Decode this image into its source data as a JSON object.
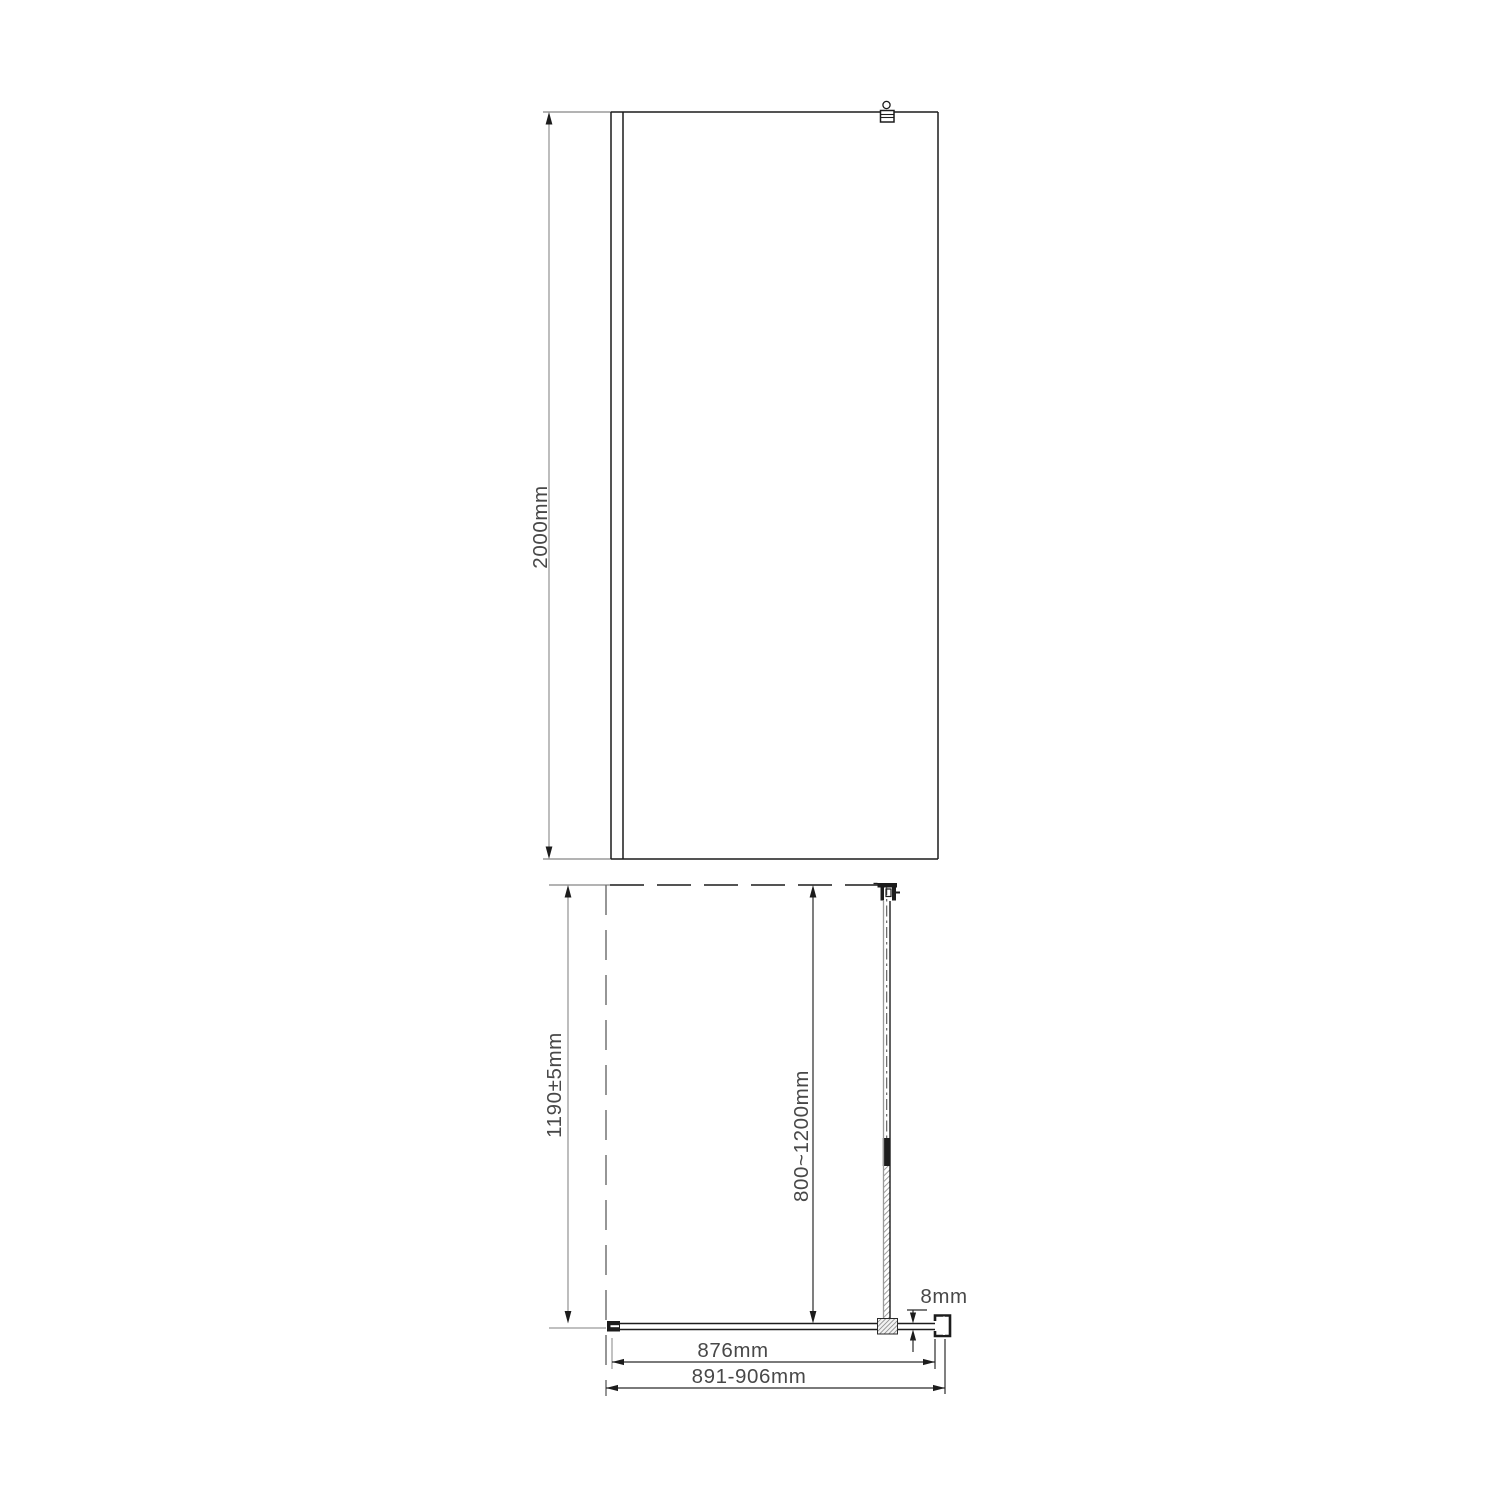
{
  "front_view": {
    "height_label": "2000mm"
  },
  "plan_view": {
    "depth_label": "1190±5mm",
    "bar_adjust_label": "800~1200mm",
    "glass_thickness_label": "8mm",
    "glass_width_label": "876mm",
    "overall_width_label": "891-906mm"
  },
  "colors": {
    "object_line": "#1c1c1c",
    "dim_line_gray": "#9a9a9a",
    "hidden_line": "#6a6a6a",
    "hatch": "#8e8e8e",
    "text": "#484848",
    "background": "#ffffff"
  }
}
